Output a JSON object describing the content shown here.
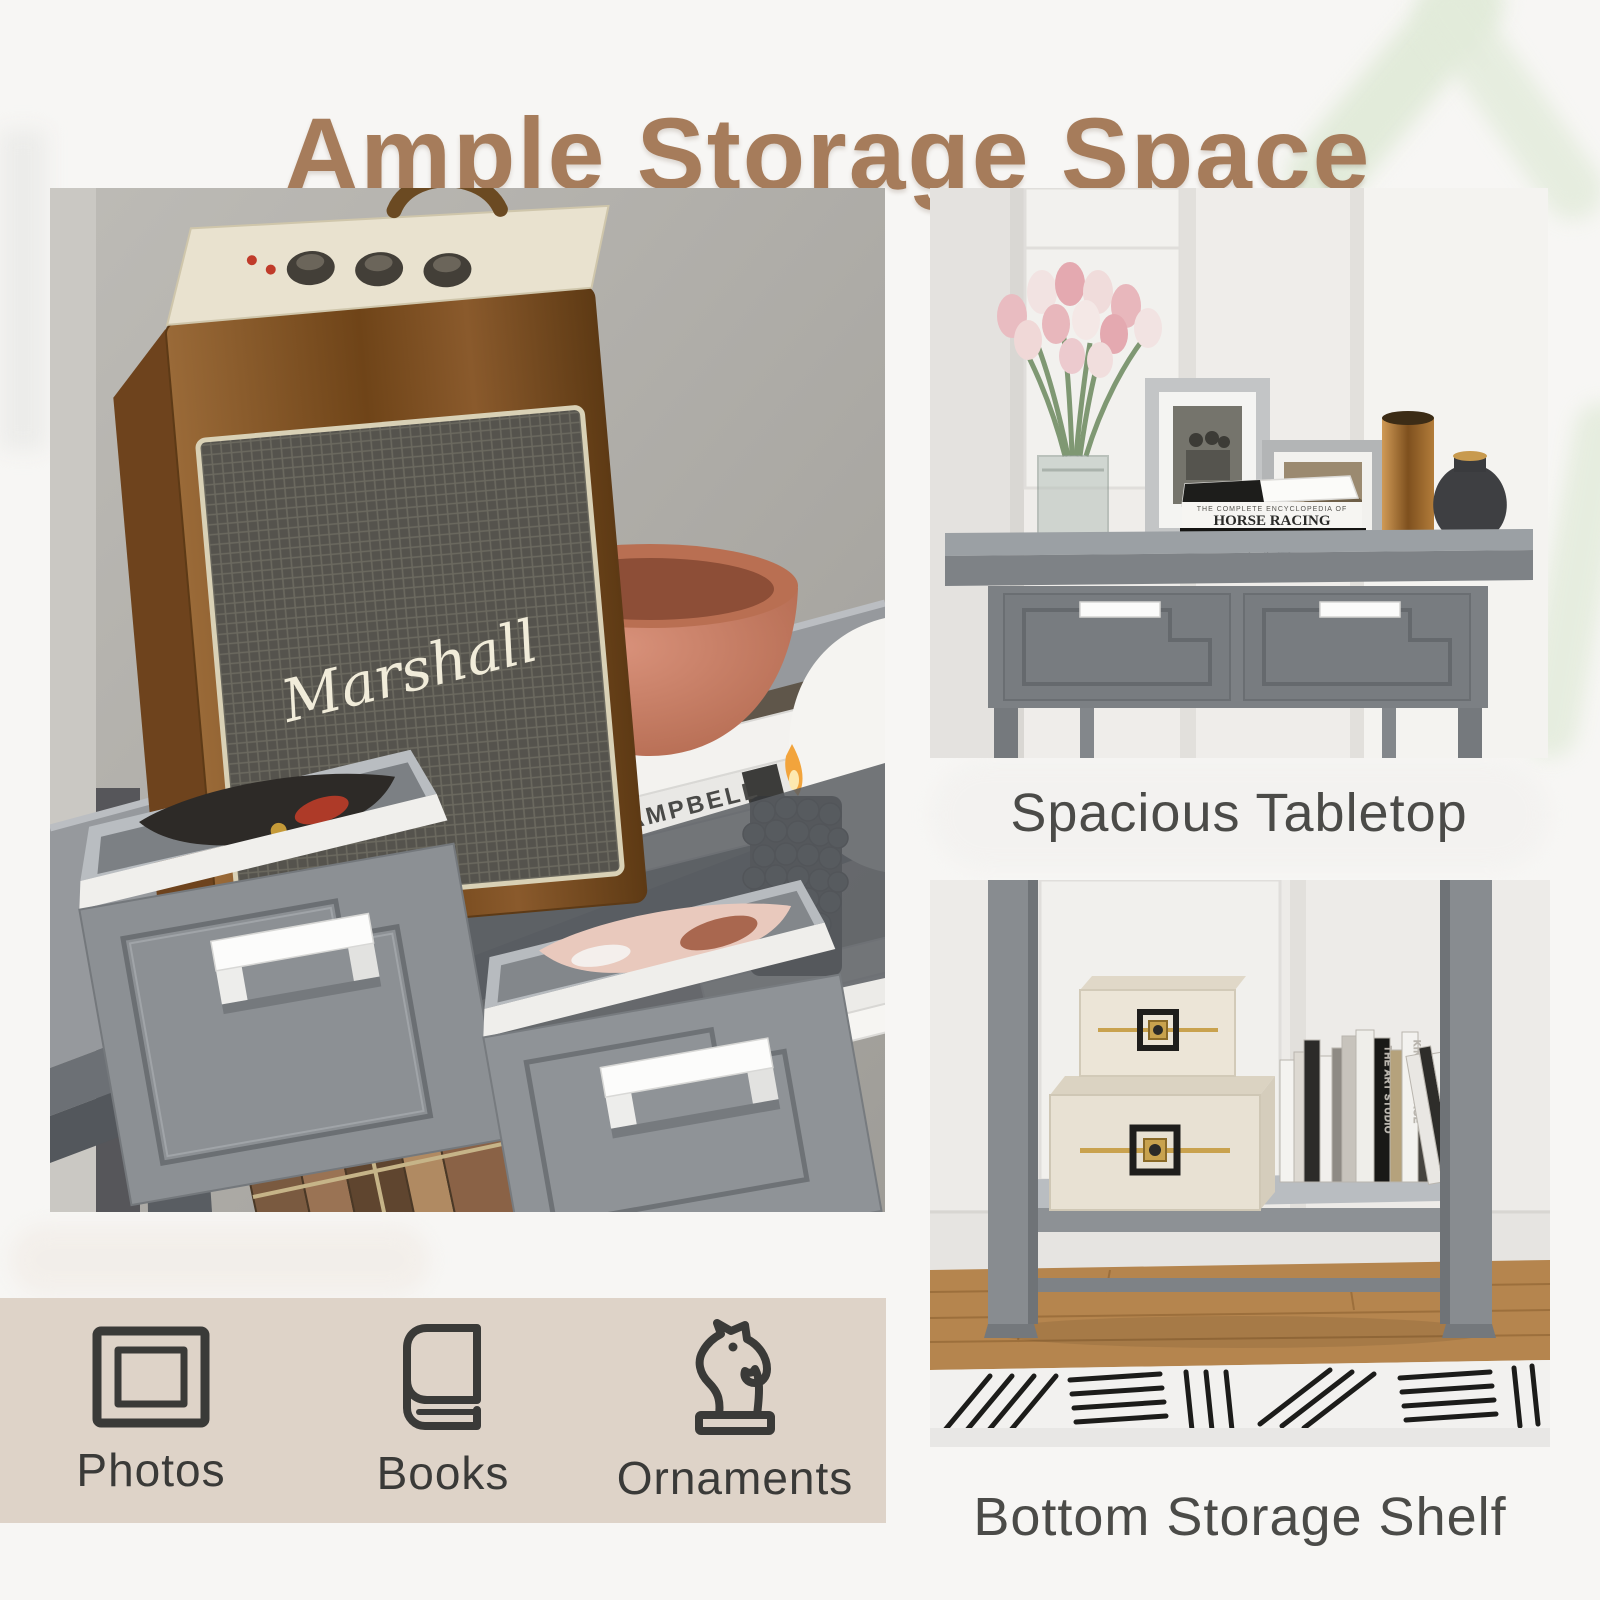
{
  "header": {
    "title": "Ample Storage Space"
  },
  "captions": {
    "tabletop": "Spacious Tabletop",
    "shelf": "Bottom Storage Shelf"
  },
  "features": {
    "items": [
      {
        "icon": "photo-frame-icon",
        "label": "Photos"
      },
      {
        "icon": "book-icon",
        "label": "Books"
      },
      {
        "icon": "chess-knight-icon",
        "label": "Ornaments"
      }
    ]
  },
  "photo_text": {
    "speaker_logo": "Marshall",
    "magazine_spine": "ABBY CAMPBELL",
    "book_stack": {
      "subtitle": "THE COMPLETE ENCYCLOPEDIA OF",
      "top": "HORSE RACING",
      "middle": "ACTING LIONS",
      "bottom": "CATS"
    },
    "shelf_spines": [
      "KINGDOMIMAGE",
      "THE ART STUDIO"
    ]
  },
  "colors": {
    "title_brown": "#a67c5b",
    "caption_gray": "#4b4b48",
    "strip_beige": "#ddd1c6",
    "icon_dark": "#3a3a38",
    "table_gray": "#85898d",
    "copper": "#c07a58"
  }
}
